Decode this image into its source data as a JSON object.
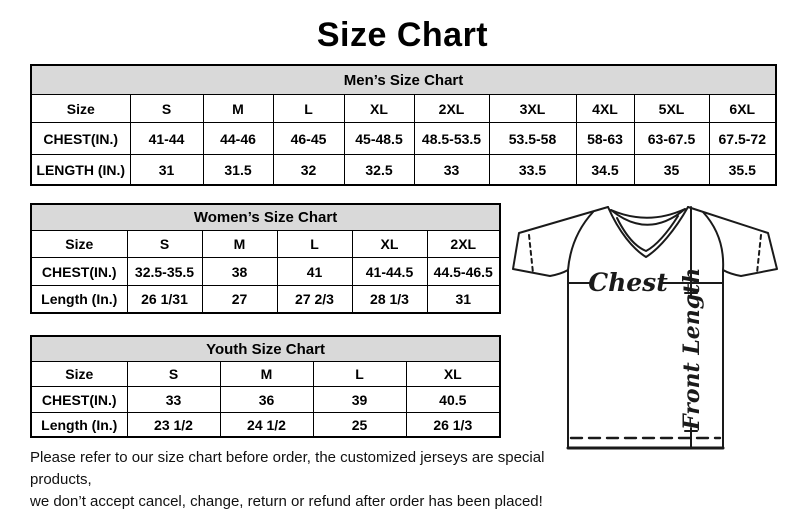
{
  "page": {
    "title": "Size Chart",
    "background_color": "#ffffff",
    "table_header_fill": "#d9d9d9",
    "border_color": "#000000"
  },
  "tables": {
    "mens": {
      "title": "Men’s Size Chart",
      "rows": [
        [
          "Size",
          "S",
          "M",
          "L",
          "XL",
          "2XL",
          "3XL",
          "4XL",
          "5XL",
          "6XL"
        ],
        [
          "CHEST(IN.)",
          "41-44",
          "44-46",
          "46-45",
          "45-48.5",
          "48.5-53.5",
          "53.5-58",
          "58-63",
          "63-67.5",
          "67.5-72"
        ],
        [
          "LENGTH (IN.)",
          "31",
          "31.5",
          "32",
          "32.5",
          "33",
          "33.5",
          "34.5",
          "35",
          "35.5"
        ]
      ]
    },
    "womens": {
      "title": "Women’s Size Chart",
      "rows": [
        [
          "Size",
          "S",
          "M",
          "L",
          "XL",
          "2XL"
        ],
        [
          "CHEST(IN.)",
          "32.5-35.5",
          "38",
          "41",
          "41-44.5",
          "44.5-46.5"
        ],
        [
          "Length (In.)",
          "26 1/31",
          "27",
          "27 2/3",
          "28 1/3",
          "31"
        ]
      ]
    },
    "youth": {
      "title": "Youth Size Chart",
      "rows": [
        [
          "Size",
          "S",
          "M",
          "L",
          "XL"
        ],
        [
          "CHEST(IN.)",
          "33",
          "36",
          "39",
          "40.5"
        ],
        [
          "Length (In.)",
          "23 1/2",
          "24 1/2",
          "25",
          "26 1/3"
        ]
      ]
    }
  },
  "diagram": {
    "chest_label": "Chest",
    "front_length_label": "Front Length"
  },
  "disclaimer": {
    "line1": "Please refer to our size chart before order, the customized jerseys are special products,",
    "line2": "we don’t accept cancel, change, return or refund after order has been placed!"
  }
}
